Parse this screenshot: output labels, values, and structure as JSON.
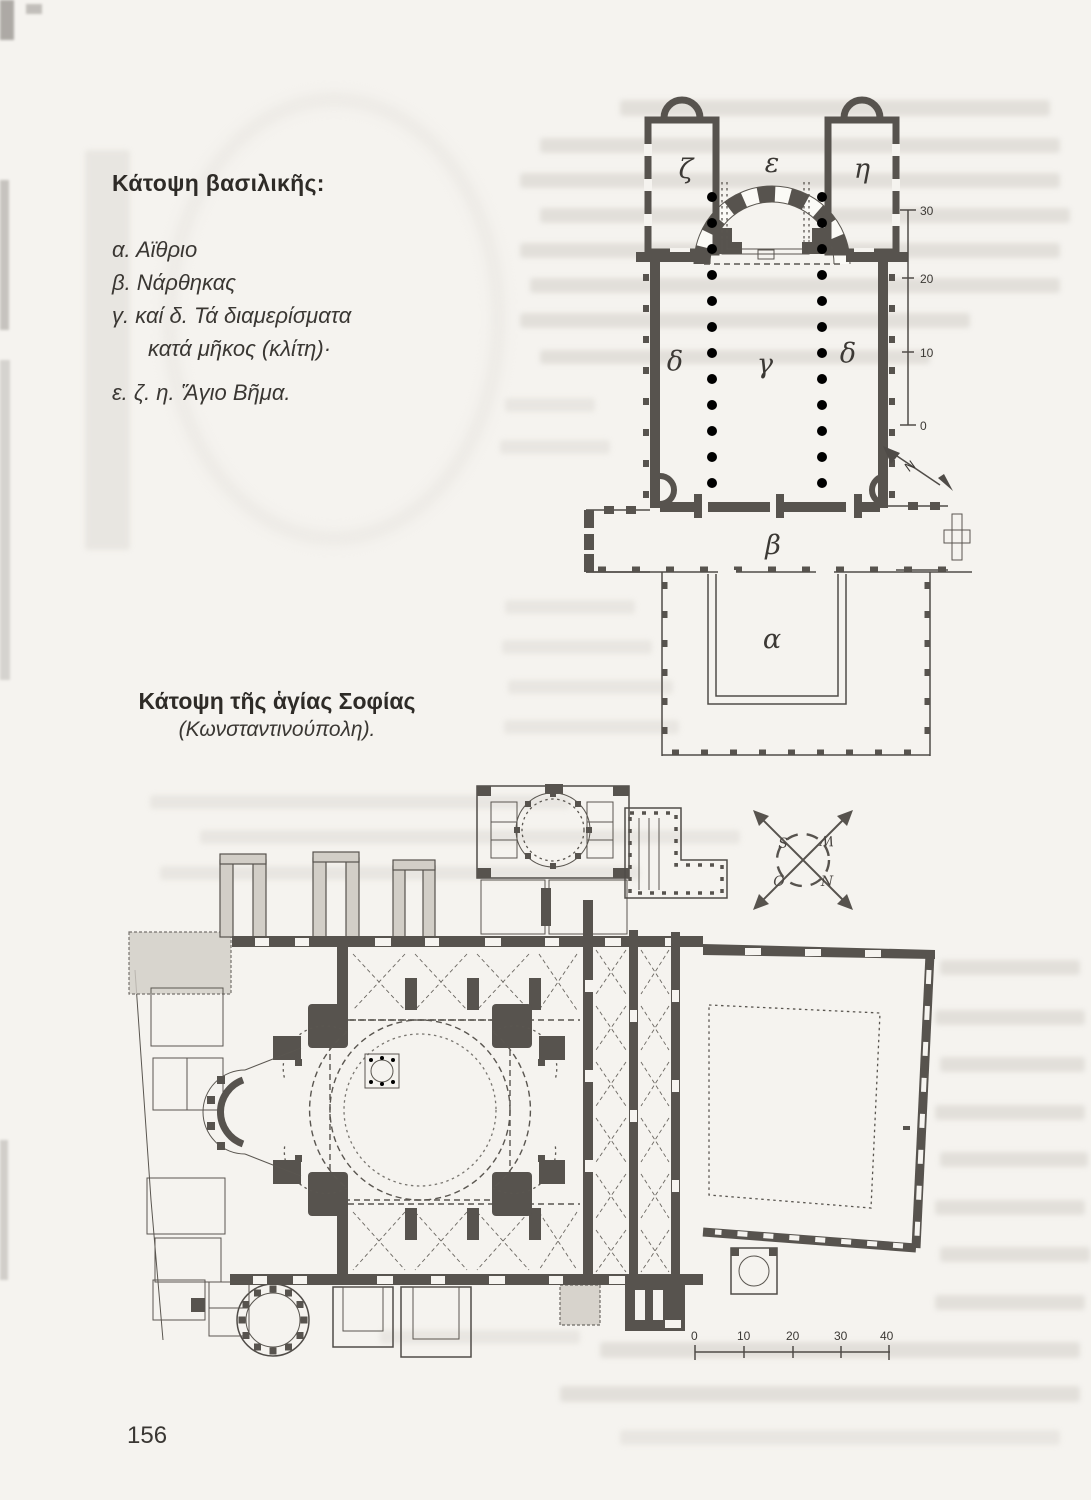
{
  "page": {
    "number": "156"
  },
  "basilica_figure": {
    "legend_title": "Κάτοψη βασιλικῆς:",
    "legend_lines": [
      "α. Αϊθριο",
      "β. Νάρθηκας",
      "γ. καί δ. Τά διαμερίσματα",
      "κατά μῆκος (κλίτη)·",
      "ε. ζ. η. Ἅγιο Βῆμα."
    ],
    "labels": {
      "chamber_left": "ζ",
      "sanctuary": "ε",
      "chamber_right": "η",
      "aisle_left": "δ",
      "nave": "γ",
      "aisle_right": "δ",
      "narthex": "β",
      "atrium": "α"
    },
    "scale_ticks": [
      "30",
      "20",
      "10",
      "0"
    ],
    "north_label": "N"
  },
  "hagia_sophia_figure": {
    "caption_title": "Κάτοψη τῆς ἁγίας Σοφίας",
    "caption_subtitle": "(Κωνσταντινούπολη).",
    "scale_ticks": [
      "0",
      "10",
      "20",
      "30",
      "40"
    ],
    "compass_letters": {
      "nw": "S",
      "ne": "W",
      "sw": "O",
      "se": "N"
    }
  }
}
